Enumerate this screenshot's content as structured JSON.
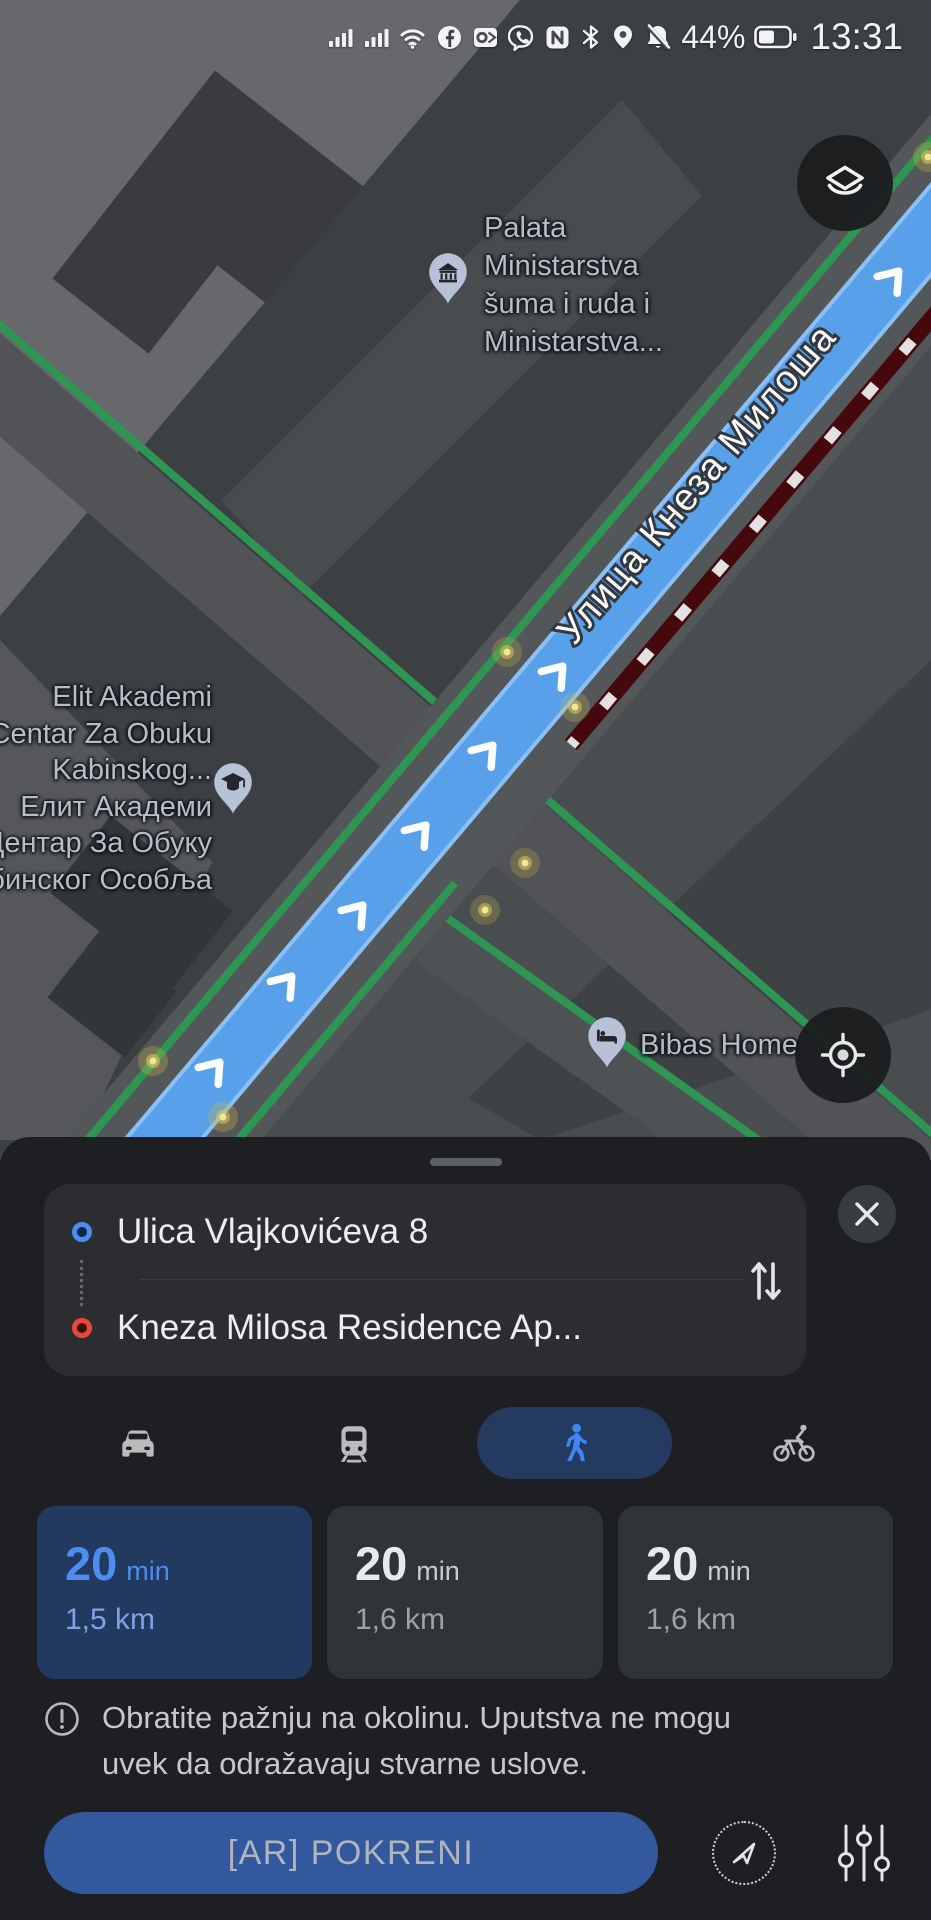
{
  "status_bar": {
    "time": "13:31",
    "battery_percent": "44%",
    "icons": [
      "signal-bars",
      "signal-bars",
      "wifi",
      "facebook",
      "outlook",
      "viber",
      "nfc",
      "bluetooth",
      "location",
      "notifications-muted",
      "battery"
    ]
  },
  "map": {
    "street_label": "Улица Кнеза Милоша",
    "controls": {
      "layers": "layers-icon",
      "locate": "locate-icon"
    },
    "pois": [
      {
        "id": "palata",
        "icon": "museum-pin",
        "lines": [
          "Palata",
          "Ministarstva",
          "šuma i ruda i",
          "Ministarstva..."
        ]
      },
      {
        "id": "elit",
        "icon": "school-pin",
        "lines": [
          "Elit Akademi",
          "Centar Za Obuku",
          "Kabinskog...",
          "Елит Академи",
          "Центар За Обуку",
          "Кабинског Особља"
        ]
      },
      {
        "id": "bibas",
        "icon": "hotel-pin",
        "lines": [
          "Bibas Home"
        ]
      }
    ]
  },
  "route_panel": {
    "origin": "Ulica Vlajkovićeva 8",
    "destination": "Kneza Milosa Residence Ap...",
    "modes": [
      {
        "id": "car",
        "selected": false
      },
      {
        "id": "transit",
        "selected": false
      },
      {
        "id": "walk",
        "selected": true
      },
      {
        "id": "bike",
        "selected": false
      }
    ],
    "options": [
      {
        "duration": "20",
        "unit": "min",
        "distance": "1,5 km",
        "selected": true
      },
      {
        "duration": "20",
        "unit": "min",
        "distance": "1,6 km",
        "selected": false
      },
      {
        "duration": "20",
        "unit": "min",
        "distance": "1,6 km",
        "selected": false
      }
    ],
    "warning_lines": [
      "Obratite pažnju na okolinu. Uputstva ne mogu",
      "uvek da odražavaju stvarne uslove."
    ],
    "ar_button_label": "[AR] POKRENI"
  },
  "colors": {
    "accent_blue": "#3f86f4",
    "route_blue": "#58a0ea",
    "tree_green": "#2e9552",
    "traffic_dark_red": "#45080d",
    "selected_card_bg": "#233a60",
    "ar_button_bg": "#33589d"
  }
}
